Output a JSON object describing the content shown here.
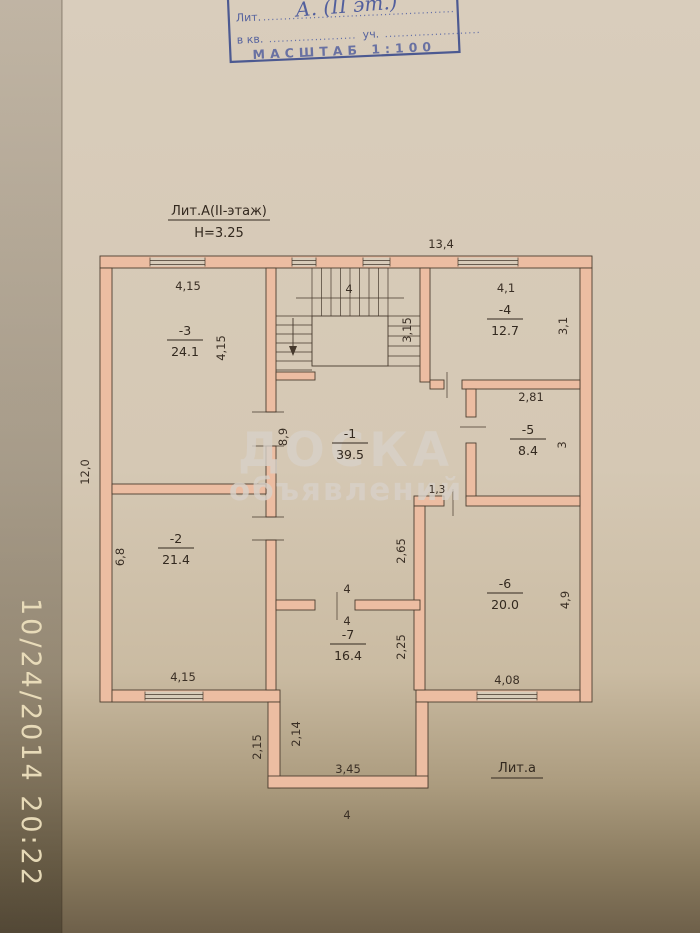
{
  "photo": {
    "timestamp": "10/24/2014 20:22"
  },
  "stamp": {
    "line1_label": "Лит.",
    "line1_dots": "..............................................",
    "line1_value": "А. (II эт.)",
    "line2_label": "в кв.",
    "line2_dots1": ".....................",
    "line2_label2": "уч.",
    "line2_dots2": ".......................",
    "scale": "МАСШТАБ 1:100"
  },
  "plan": {
    "title": "Лит.А(II-этаж)",
    "height": "Н=3.25",
    "annex_label": "Лит.а",
    "watermark1": "ДОСКА",
    "watermark2": "объявлений",
    "rooms": [
      {
        "num": "-1",
        "area": "39.5"
      },
      {
        "num": "-2",
        "area": "21.4"
      },
      {
        "num": "-3",
        "area": "24.1"
      },
      {
        "num": "-4",
        "area": "12.7"
      },
      {
        "num": "-5",
        "area": "8.4"
      },
      {
        "num": "-6",
        "area": "20.0"
      },
      {
        "num": "-7",
        "area": "16.4"
      }
    ],
    "dims": {
      "outer_top": "13,4",
      "outer_left": "12,0",
      "r3_top": "4,15",
      "r3_right": "4,15",
      "stairs_top": "4",
      "stairs_right": "3,15",
      "r4_top": "4,1",
      "r4_right": "3,1",
      "r5_top": "2,81",
      "r5_right": "3",
      "r1_left": "8,9",
      "jog": "1,3",
      "r2_left": "6,8",
      "r2_bottom": "4,15",
      "hall_right": "2,65",
      "r7_top_upper": "4",
      "r7_top_lower": "4",
      "r7_right": "2,25",
      "r6_right": "4,9",
      "r6_bottom": "4,08",
      "porch_left_outer": "2,15",
      "porch_left_inner": "2,14",
      "porch_bottom": "3,45",
      "porch_outer": "4"
    }
  }
}
